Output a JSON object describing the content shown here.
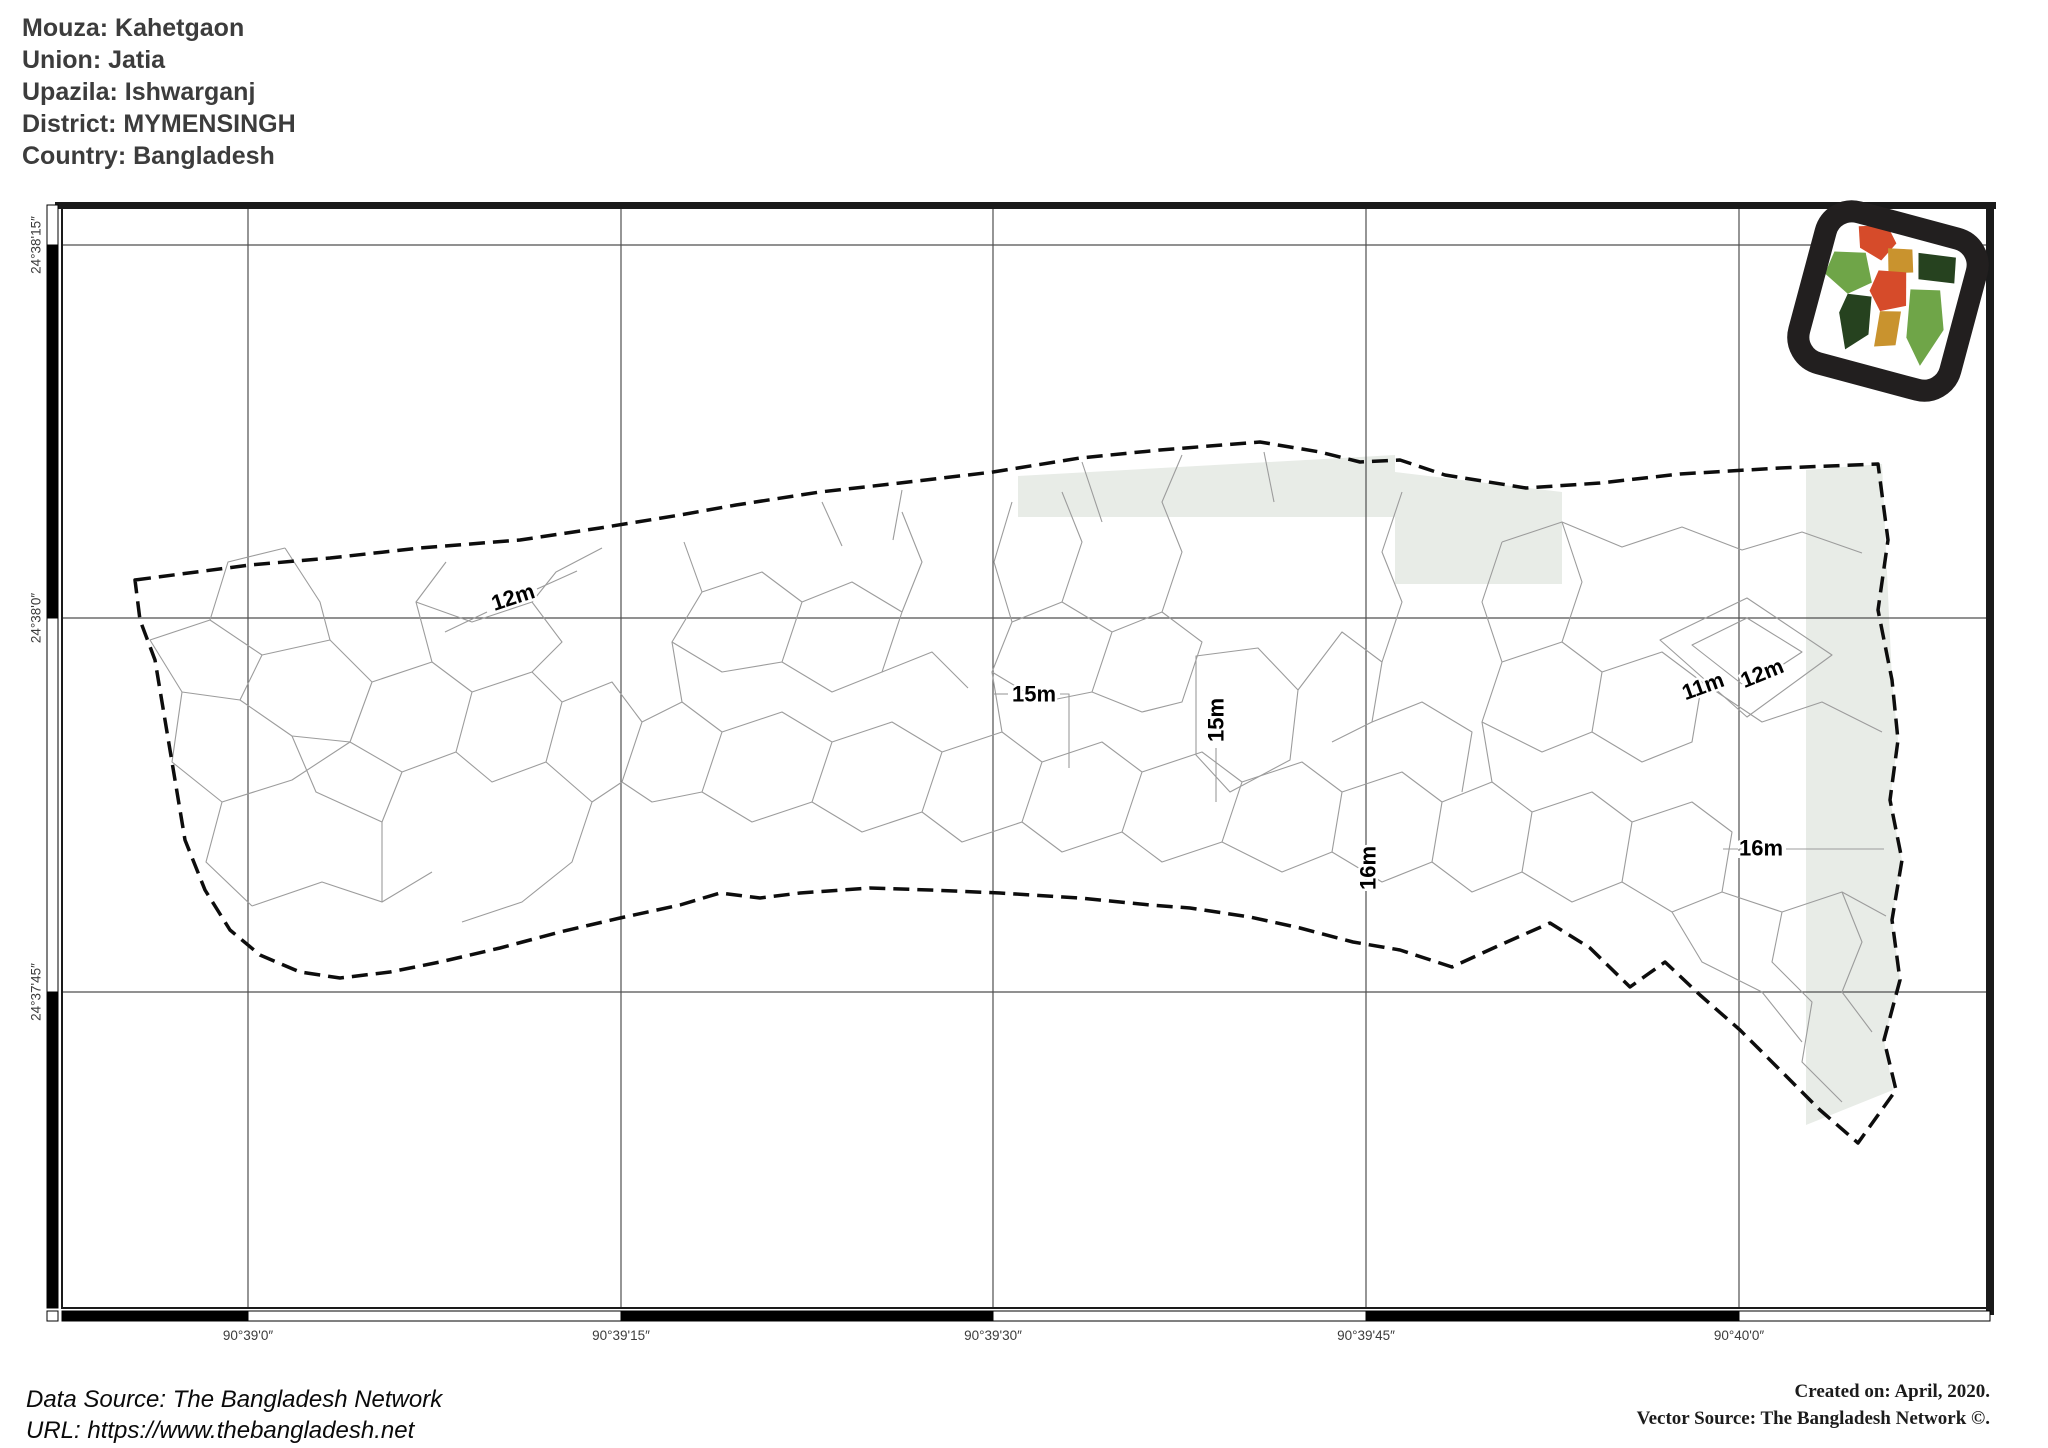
{
  "header": {
    "lines": [
      "Mouza: Kahetgaon",
      "Union: Jatia",
      "Upazila: Ishwarganj",
      "District: MYMENSINGH",
      "Country: Bangladesh"
    ]
  },
  "footer": {
    "left": [
      "Data Source: The Bangladesh Network",
      "URL: https://www.thebangladesh.net"
    ],
    "right": [
      "Created on: April, 2020.",
      "Vector Source: The Bangladesh Network ©."
    ]
  },
  "map": {
    "frame": {
      "x": 62,
      "y": 205,
      "w": 1928,
      "h": 1103
    },
    "colors": {
      "tint": "#e8ece7",
      "contour": "#9c9c9c",
      "boundary": "#0d0d0d",
      "grid": "#4f4f4f",
      "frame": "#1a1a1a",
      "tick_text": "#3c3c3c",
      "logo_frame": "#221f1f",
      "logo_red": "#d64b2a",
      "logo_green": "#6fa548",
      "logo_dark_green": "#26421f",
      "logo_gold": "#c9932e"
    },
    "lat_ticks": [
      {
        "label": "24°38'15″",
        "y": 245
      },
      {
        "label": "24°38'0″",
        "y": 618
      },
      {
        "label": "24°37'45″",
        "y": 992
      }
    ],
    "lon_ticks": [
      {
        "label": "90°39'0″",
        "x": 248
      },
      {
        "label": "90°39'15″",
        "x": 621
      },
      {
        "label": "90°39'30″",
        "x": 993
      },
      {
        "label": "90°39'45″",
        "x": 1366
      },
      {
        "label": "90°40'0″",
        "x": 1739
      }
    ],
    "neatline": {
      "left_segments": [
        {
          "from": 205,
          "to": 245,
          "color": "#ffffff"
        },
        {
          "from": 245,
          "to": 618,
          "color": "#000000"
        },
        {
          "from": 618,
          "to": 992,
          "color": "#ffffff"
        },
        {
          "from": 992,
          "to": 1308,
          "color": "#000000"
        }
      ],
      "bottom_segments": [
        {
          "from": 62,
          "to": 248,
          "color": "#000000"
        },
        {
          "from": 248,
          "to": 621,
          "color": "#ffffff"
        },
        {
          "from": 621,
          "to": 993,
          "color": "#000000"
        },
        {
          "from": 993,
          "to": 1366,
          "color": "#ffffff"
        },
        {
          "from": 1366,
          "to": 1739,
          "color": "#000000"
        },
        {
          "from": 1739,
          "to": 1990,
          "color": "#ffffff"
        }
      ]
    },
    "tints": [
      "M1018,476 L1395,455 L1395,517 L1018,517 Z",
      "M1395,472 L1562,492 L1562,584 L1395,584 Z",
      "M1806,470 L1882,464 L1892,680 L1898,740 L1890,800 L1902,860 L1892,920 L1900,980 L1884,1040 L1893,1090 L1806,1125 Z"
    ],
    "boundary": "M135,580 L250,565 L330,558 L420,548 L520,540 L600,528 L680,515 L736,505 L820,492 L900,483 L993,472 L1080,458 L1160,450 L1260,442 L1320,452 L1360,462 L1400,460 L1445,475 L1526,488 L1600,483 L1680,474 L1780,468 L1878,464 L1888,540 L1878,610 L1892,680 L1898,740 L1890,800 L1902,860 L1892,920 L1900,980 L1884,1040 L1896,1090 L1858,1143 L1820,1110 L1780,1070 L1740,1030 L1700,995 L1665,962 L1630,987 L1590,948 L1550,923 L1500,945 L1452,967 L1400,950 L1353,942 L1300,928 L1250,917 L1190,908 L1150,905 L1080,898 L1000,893 L930,890 L870,888 L800,893 L760,898 L720,893 L680,905 L620,918 L560,932 L500,948 L440,962 L390,972 L340,978 L300,972 L260,955 L230,930 L205,890 L185,840 L175,780 L165,720 L155,660 L140,620 Z",
    "contours": [
      "M150,640 L210,620 L262,655 L240,700 L182,692 Z",
      "M210,620 L228,562 L285,548",
      "M262,655 L330,640 L372,682 L350,742 L292,736 L240,700",
      "M285,548 L320,602 L330,640",
      "M182,692 L172,762 L222,802 L206,862 L252,906",
      "M222,802 L292,780 L350,742",
      "M252,906 L322,882 L382,902 L432,872",
      "M292,736 L316,792 L382,822 L382,902",
      "M372,682 L432,662 L472,692 L456,752 L402,772 L350,742",
      "M432,662 L416,602 L446,562",
      "M472,692 L532,672 L562,702 L546,762 L492,782 L456,752",
      "M416,602 L472,622 L532,602 L562,642 L532,672",
      "M546,762 L592,802 L572,862 L522,902 L462,922",
      "M382,822 L402,772",
      "M562,702 L612,682 L642,722 L622,782 L592,802",
      "M445,632 L487,612",
      "M537,589 L577,571",
      "M532,602 L556,572 L602,548",
      "M642,722 L682,702 L722,732 L702,792 L652,802 L622,782",
      "M682,702 L672,642 L702,592 L684,542",
      "M702,592 L762,572 L802,602 L782,662 L722,672 L672,642",
      "M722,732 L782,712 L832,742 L812,802 L752,822 L702,792",
      "M802,602 L852,582 L902,612 L882,672 L832,692 L782,662",
      "M832,742 L892,722 L942,752 L922,812 L862,832 L812,802",
      "M902,612 L922,562 L902,512",
      "M942,752 L1002,732 L1042,762 L1022,822 L962,842 L922,812",
      "M882,672 L932,652 L968,688",
      "M1002,732 L992,672 L1012,622 L994,562 L1012,502",
      "M1042,762 L1102,742 L1142,772 L1122,832 L1062,852 L1022,822",
      "M1012,622 L1062,602 L1112,632 L1092,692 L1042,702 L992,672",
      "M1062,602 L1082,542 L1062,492",
      "M993,694 L1008,694",
      "M1060,694 L1069,694 L1069,768",
      "M822,502 L842,546",
      "M902,490 L893,540",
      "M1142,772 L1202,752 L1242,782 L1222,842 L1162,862 L1122,832",
      "M1112,632 L1162,612 L1202,642 L1182,702 L1142,712 L1092,692",
      "M1162,612 L1182,552 L1162,502 L1182,455",
      "M1196,656 L1258,648 L1298,690 L1290,760 L1230,792 L1196,755 Z",
      "M1216,748 L1216,802",
      "M1242,782 L1302,762 L1342,792 L1332,852 L1282,872 L1222,842",
      "M1298,690 L1342,632 L1382,662 L1372,722 L1332,742",
      "M1342,792 L1402,772 L1442,802 L1432,862 L1382,882 L1332,852",
      "M1382,662 L1402,602 L1382,552 L1402,492",
      "M1442,802 L1492,782 L1532,812 L1522,872 L1472,892 L1432,862",
      "M1372,722 L1422,702 L1472,732 L1462,792",
      "M1264,452 L1274,502",
      "M1082,462 L1102,522",
      "M1532,812 L1592,792 L1632,822 L1622,882 L1572,902 L1522,872",
      "M1492,782 L1482,722 L1502,662 L1482,602 L1502,542",
      "M1502,662 L1562,642 L1602,672 L1592,732 L1542,752 L1482,722",
      "M1562,642 L1582,582 L1562,522",
      "M1602,672 L1662,652 L1702,682 L1692,742 L1642,762 L1592,732",
      "M1660,640 L1747,598 L1832,655 L1747,717 Z",
      "M1692,645 L1747,618 L1802,652 L1747,688 Z",
      "M1632,822 L1692,802 L1732,832 L1722,892 L1672,912 L1622,882",
      "M1702,682 L1762,722 L1822,702 L1882,732",
      "M1723,849 L1742,849",
      "M1786,849 L1884,849",
      "M1722,892 L1782,912 L1842,892 L1886,916",
      "M1672,912 L1702,962 L1762,992 L1802,1042",
      "M1782,912 L1772,962 L1812,1002 L1802,1062 L1842,1102",
      "M1842,892 L1862,942 L1842,992 L1872,1032",
      "M1502,542 L1562,522 L1622,547 L1682,527 L1742,550 L1802,532 L1862,553"
    ],
    "contour_labels": [
      {
        "text": "12m",
        "x": 513,
        "y": 597,
        "rot": -18
      },
      {
        "text": "15m",
        "x": 1034,
        "y": 694,
        "rot": 0
      },
      {
        "text": "15m",
        "x": 1216,
        "y": 720,
        "rot": -90
      },
      {
        "text": "16m",
        "x": 1368,
        "y": 868,
        "rot": -90
      },
      {
        "text": "11m",
        "x": 1703,
        "y": 686,
        "rot": -20
      },
      {
        "text": "12m",
        "x": 1762,
        "y": 673,
        "rot": -22
      },
      {
        "text": "16m",
        "x": 1761,
        "y": 848,
        "rot": 0
      }
    ],
    "logo": {
      "x": 1888,
      "y": 301,
      "rot": 15,
      "scale": 1.7,
      "regions": [
        {
          "d": "M22,12 L38,7 L46,16 L40,28 L26,24 Z",
          "color": "logo_red"
        },
        {
          "d": "M12,30 L30,26 L38,42 L26,52 L10,44 Z",
          "color": "logo_green"
        },
        {
          "d": "M42,20 L56,17 L60,30 L46,34 Z",
          "color": "logo_gold"
        },
        {
          "d": "M60,18 L82,15 L85,30 L64,33 Z",
          "color": "logo_dark_green"
        },
        {
          "d": "M40,34 L56,31 L61,50 L47,57 L38,47 Z",
          "color": "logo_red"
        },
        {
          "d": "M26,52 L40,50 L44,72 L33,84 L24,64 Z",
          "color": "logo_dark_green"
        },
        {
          "d": "M47,57 L59,54 L61,74 L49,78 Z",
          "color": "logo_gold"
        },
        {
          "d": "M61,40 L78,36 L86,58 L78,82 L66,68 Z",
          "color": "logo_green"
        }
      ]
    }
  }
}
